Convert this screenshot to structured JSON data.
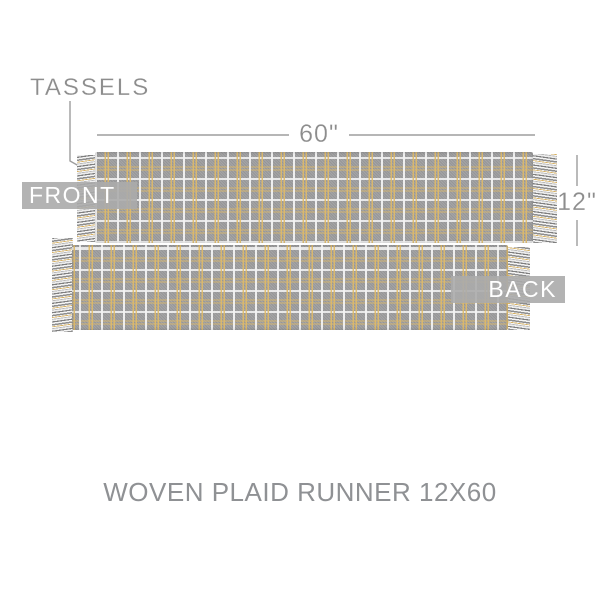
{
  "annotations": {
    "tassels_label": "TASSELS",
    "width_label": "60\"",
    "height_label": "12\""
  },
  "badges": {
    "front": "FRONT",
    "back": "BACK"
  },
  "title": "WOVEN PLAID RUNNER 12X60",
  "colors": {
    "fabric_gray": "#9e9e9f",
    "plaid_white": "#f2f2f2",
    "plaid_gold": "#dfba68",
    "fringe_gray": "#8e8e8e",
    "annotation_text_gray": "#8d8d8d",
    "annotation_line_gray": "#9d9d9d",
    "badge_overlay": "rgba(171,171,171,0.9)",
    "badge_text": "#ffffff",
    "background": "#ffffff"
  }
}
